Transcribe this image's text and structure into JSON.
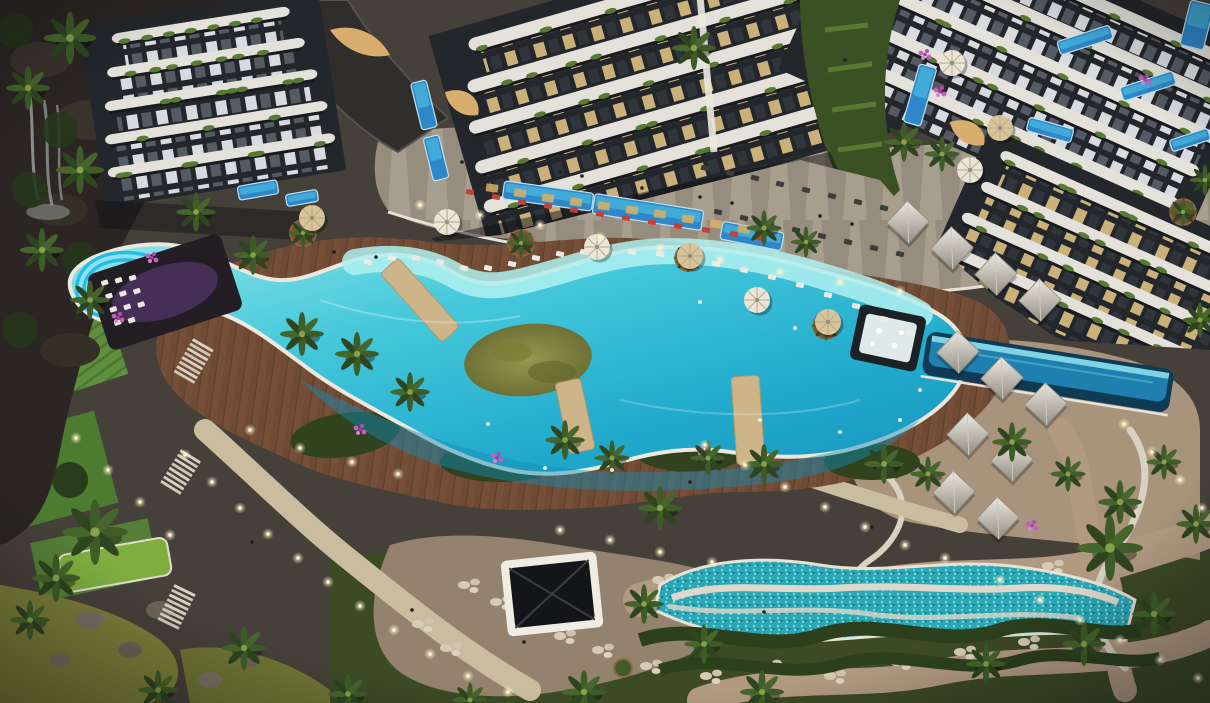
{
  "scene": {
    "description": "Night-time aerial 3D render of a luxury residential resort: curved white apartment towers at top, large S-shaped turquoise lagoon pool with olive green island and blue waterslide, brown timber sun deck with palms and umbrellas, left cliff waterfall and terraced lawns, bottom mosaic pool, stone plaza with dark gazebo, pyramid-roof cabanas and lit garden paths at right",
    "palette": {
      "ground": "#46403a",
      "cliff": "#2b2623",
      "rock": "#3a332c",
      "deck": "#6f4a34",
      "promenade": "#978d7e",
      "wall": "#e6e2d6",
      "poolRim": "#ece8dc",
      "shelf": "#aff0f0",
      "island": "#90904c",
      "islandDark": "#6e7135",
      "slide": "#25bde6",
      "slideHi": "#8fe2f4",
      "bridge": "#cdb489",
      "slab": "#e3e1da",
      "facadeDark": "#23262b",
      "tuft": "#5a7a34",
      "lawn1": "#5d8f3d",
      "lawn2": "#4d7c31",
      "lawn3": "#7fae3f",
      "garden": "#3c4a26",
      "gardenDark": "#26361c",
      "pond": "#7c7f39",
      "pond2": "#6f7434",
      "plaza": "#93836e",
      "path": "#cabc9f",
      "pathPink": "#b29a82",
      "sand": "#a8937c",
      "mosaic": "#2aa7b5",
      "hedge": "#2c401e",
      "umbrella": "#eae5d7",
      "umbrellaTan": "#d9c49a",
      "palm": "#3f5c28",
      "palmDark": "#2e4520",
      "planter": "#7a5136",
      "flower": "#c75fc0",
      "barGlow": "#8a4fb4",
      "barDark": "#221e24",
      "red": "#c24038",
      "loungerWhite": "#eceae2",
      "loungerDark": "#3c3c38",
      "infinityDeep": "#0f3b55",
      "infinityMid": "#1f7fae",
      "gold": "#d8ad6e"
    },
    "buildings": [
      {
        "name": "tower-left",
        "tx": 200,
        "ty": 20,
        "rot": -9,
        "pitch": 33,
        "slabH": 10,
        "winH": 22,
        "pat": "winA",
        "widths": [
          180,
          200,
          215,
          225,
          230
        ]
      },
      {
        "name": "tower-center",
        "tx": 640,
        "ty": -10,
        "rot": -16,
        "pitch": 40,
        "slabH": 13,
        "winH": 27,
        "pat": "winB",
        "widths": [
          360,
          385,
          405,
          415,
          420
        ]
      },
      {
        "name": "tower-right",
        "tx": 1060,
        "ty": -20,
        "rot": 24,
        "pitch": 38,
        "slabH": 12,
        "winH": 25,
        "pat": "winA",
        "widths": [
          430,
          430,
          420,
          410,
          400
        ]
      },
      {
        "name": "wing-right",
        "tx": 1140,
        "ty": 210,
        "rot": 24,
        "pitch": 36,
        "slabH": 11,
        "winH": 24,
        "pat": "winB",
        "widths": [
          300,
          310,
          320,
          330
        ]
      }
    ],
    "privatePools": [
      [
        258,
        190,
        40,
        14,
        -10
      ],
      [
        302,
        198,
        32,
        12,
        -10
      ],
      [
        424,
        105,
        16,
        48,
        -14
      ],
      [
        436,
        158,
        16,
        44,
        -14
      ],
      [
        548,
        196,
        90,
        18,
        8
      ],
      [
        648,
        212,
        110,
        20,
        9
      ],
      [
        752,
        236,
        62,
        18,
        11
      ],
      [
        920,
        95,
        18,
        60,
        16
      ],
      [
        1085,
        40,
        55,
        14,
        -18
      ],
      [
        1148,
        86,
        55,
        14,
        -18
      ],
      [
        1190,
        140,
        40,
        12,
        -18
      ],
      [
        1197,
        25,
        24,
        46,
        14
      ],
      [
        1050,
        130,
        46,
        14,
        16
      ]
    ],
    "cabanas": [
      [
        908,
        222
      ],
      [
        952,
        248
      ],
      [
        996,
        274
      ],
      [
        1040,
        300
      ],
      [
        958,
        352
      ],
      [
        1002,
        378
      ],
      [
        1046,
        404
      ],
      [
        968,
        434
      ],
      [
        1012,
        460
      ],
      [
        954,
        492
      ],
      [
        998,
        518
      ]
    ],
    "planters": [
      [
        303,
        233
      ],
      [
        521,
        243
      ],
      [
        688,
        258
      ],
      [
        826,
        326
      ],
      [
        1183,
        212
      ]
    ],
    "umbrellasWhite": [
      [
        447,
        222
      ],
      [
        597,
        247
      ],
      [
        757,
        300
      ],
      [
        952,
        63
      ],
      [
        970,
        170
      ]
    ],
    "umbrellasTan": [
      [
        312,
        218
      ],
      [
        690,
        256
      ],
      [
        828,
        322
      ],
      [
        1000,
        128
      ]
    ],
    "palms": [
      [
        70,
        38,
        1.2
      ],
      [
        28,
        88,
        1
      ],
      [
        80,
        170,
        1.1
      ],
      [
        42,
        250,
        1
      ],
      [
        90,
        300,
        0.9
      ],
      [
        95,
        532,
        1.5
      ],
      [
        56,
        578,
        1.1
      ],
      [
        30,
        620,
        0.9
      ],
      [
        196,
        212,
        0.9
      ],
      [
        253,
        255,
        0.9
      ],
      [
        302,
        334,
        1
      ],
      [
        357,
        354,
        1
      ],
      [
        410,
        392,
        0.9
      ],
      [
        565,
        440,
        0.9
      ],
      [
        612,
        458,
        0.8
      ],
      [
        660,
        508,
        1
      ],
      [
        708,
        458,
        0.8
      ],
      [
        764,
        464,
        0.9
      ],
      [
        884,
        464,
        0.9
      ],
      [
        928,
        474,
        0.8
      ],
      [
        1012,
        442,
        0.9
      ],
      [
        1068,
        474,
        0.8
      ],
      [
        1120,
        502,
        1
      ],
      [
        1164,
        462,
        0.8
      ],
      [
        1110,
        548,
        1.5
      ],
      [
        1196,
        524,
        0.9
      ],
      [
        1154,
        614,
        1
      ],
      [
        1084,
        644,
        1
      ],
      [
        986,
        664,
        0.9
      ],
      [
        762,
        692,
        1
      ],
      [
        704,
        644,
        0.9
      ],
      [
        644,
        604,
        0.9
      ],
      [
        584,
        692,
        1
      ],
      [
        694,
        48,
        1
      ],
      [
        764,
        228,
        0.8
      ],
      [
        806,
        242,
        0.7
      ],
      [
        904,
        142,
        0.9
      ],
      [
        942,
        154,
        0.8
      ],
      [
        244,
        648,
        1
      ],
      [
        158,
        690,
        0.9
      ],
      [
        1200,
        320,
        0.8
      ],
      [
        1205,
        180,
        0.7
      ],
      [
        348,
        694,
        0.9
      ],
      [
        470,
        700,
        0.8
      ]
    ],
    "lights": [
      [
        185,
        455
      ],
      [
        212,
        482
      ],
      [
        240,
        508
      ],
      [
        268,
        534
      ],
      [
        298,
        558
      ],
      [
        328,
        582
      ],
      [
        360,
        606
      ],
      [
        394,
        630
      ],
      [
        430,
        654
      ],
      [
        468,
        676
      ],
      [
        508,
        692
      ],
      [
        705,
        445
      ],
      [
        745,
        465
      ],
      [
        785,
        487
      ],
      [
        825,
        507
      ],
      [
        865,
        527
      ],
      [
        905,
        545
      ],
      [
        945,
        558
      ],
      [
        1000,
        580
      ],
      [
        1040,
        600
      ],
      [
        1080,
        620
      ],
      [
        1120,
        640
      ],
      [
        1160,
        660
      ],
      [
        1198,
        678
      ],
      [
        1124,
        424
      ],
      [
        1152,
        452
      ],
      [
        1180,
        480
      ],
      [
        1202,
        508
      ],
      [
        420,
        205
      ],
      [
        480,
        215
      ],
      [
        540,
        225
      ],
      [
        600,
        237
      ],
      [
        660,
        248
      ],
      [
        720,
        260
      ],
      [
        780,
        272
      ],
      [
        840,
        282
      ],
      [
        900,
        291
      ],
      [
        250,
        430
      ],
      [
        300,
        448
      ],
      [
        352,
        462
      ],
      [
        398,
        474
      ],
      [
        560,
        530
      ],
      [
        610,
        540
      ],
      [
        660,
        552
      ],
      [
        712,
        562
      ],
      [
        76,
        438
      ],
      [
        108,
        470
      ],
      [
        140,
        502
      ],
      [
        170,
        535
      ]
    ],
    "loungersRed": [
      [
        470,
        192
      ],
      [
        496,
        197
      ],
      [
        522,
        202
      ],
      [
        548,
        206
      ],
      [
        574,
        210
      ],
      [
        600,
        214
      ],
      [
        626,
        218
      ],
      [
        652,
        222
      ],
      [
        678,
        226
      ],
      [
        706,
        230
      ],
      [
        734,
        234
      ],
      [
        760,
        238
      ]
    ],
    "loungersDark": [
      [
        705,
        168
      ],
      [
        730,
        173
      ],
      [
        755,
        178
      ],
      [
        780,
        184
      ],
      [
        806,
        190
      ],
      [
        832,
        196
      ],
      [
        858,
        202
      ],
      [
        884,
        208
      ],
      [
        718,
        212
      ],
      [
        744,
        218
      ],
      [
        770,
        224
      ],
      [
        796,
        230
      ],
      [
        822,
        236
      ],
      [
        848,
        242
      ],
      [
        874,
        248
      ],
      [
        900,
        254
      ]
    ],
    "loungersPool": [
      [
        368,
        262
      ],
      [
        392,
        258
      ],
      [
        416,
        258
      ],
      [
        440,
        262
      ],
      [
        464,
        268
      ],
      [
        488,
        268
      ],
      [
        512,
        264
      ],
      [
        536,
        258
      ],
      [
        560,
        254
      ],
      [
        584,
        252
      ],
      [
        608,
        252
      ],
      [
        632,
        252
      ],
      [
        660,
        254
      ],
      [
        688,
        258
      ],
      [
        716,
        264
      ],
      [
        744,
        270
      ],
      [
        772,
        277
      ],
      [
        800,
        285
      ],
      [
        828,
        295
      ],
      [
        856,
        306
      ],
      [
        884,
        319
      ],
      [
        910,
        333
      ]
    ],
    "glowWindows": [
      [
        492,
        188
      ],
      [
        520,
        193
      ],
      [
        548,
        198
      ],
      [
        576,
        202
      ],
      [
        604,
        206
      ],
      [
        632,
        210
      ],
      [
        660,
        214
      ],
      [
        688,
        219
      ],
      [
        716,
        224
      ],
      [
        744,
        229
      ]
    ],
    "flowers": [
      [
        925,
        55
      ],
      [
        940,
        92
      ],
      [
        360,
        430
      ],
      [
        497,
        458
      ],
      [
        702,
        450
      ],
      [
        884,
        464
      ],
      [
        1032,
        526
      ],
      [
        118,
        318
      ],
      [
        1145,
        80
      ],
      [
        152,
        258
      ]
    ],
    "stones": [
      [
        470,
        585
      ],
      [
        502,
        602
      ],
      [
        534,
        620
      ],
      [
        566,
        636
      ],
      [
        604,
        650
      ],
      [
        648,
        598
      ],
      [
        664,
        580
      ],
      [
        702,
        594
      ],
      [
        742,
        608
      ],
      [
        782,
        596
      ],
      [
        832,
        610
      ],
      [
        872,
        586
      ],
      [
        918,
        600
      ],
      [
        962,
        588
      ],
      [
        1008,
        576
      ],
      [
        1054,
        566
      ],
      [
        652,
        666
      ],
      [
        712,
        676
      ],
      [
        772,
        666
      ],
      [
        836,
        676
      ],
      [
        902,
        662
      ],
      [
        966,
        652
      ],
      [
        1030,
        642
      ],
      [
        452,
        648
      ],
      [
        424,
        624
      ]
    ],
    "stairs": [
      [
        193,
        362,
        30
      ],
      [
        180,
        473,
        32
      ],
      [
        176,
        608,
        26
      ]
    ],
    "people": [
      [
        560,
        172
      ],
      [
        582,
        176
      ],
      [
        612,
        182
      ],
      [
        642,
        188
      ],
      [
        700,
        197
      ],
      [
        732,
        203
      ],
      [
        462,
        162
      ],
      [
        820,
        216
      ],
      [
        852,
        224
      ],
      [
        334,
        252
      ],
      [
        376,
        257
      ],
      [
        690,
        482
      ],
      [
        872,
        527
      ],
      [
        252,
        542
      ],
      [
        412,
        610
      ],
      [
        524,
        642
      ],
      [
        764,
        612
      ],
      [
        950,
        120
      ],
      [
        845,
        60
      ]
    ],
    "swimmers": [
      [
        488,
        424
      ],
      [
        545,
        468
      ],
      [
        612,
        470
      ],
      [
        840,
        432
      ],
      [
        900,
        420
      ],
      [
        795,
        328
      ],
      [
        700,
        302
      ],
      [
        760,
        420
      ],
      [
        920,
        390
      ]
    ],
    "cliffTrees": [
      [
        15,
        30
      ],
      [
        60,
        130
      ],
      [
        30,
        190
      ],
      [
        80,
        260
      ],
      [
        20,
        330
      ],
      [
        70,
        480
      ]
    ],
    "rocks": [
      [
        90,
        620
      ],
      [
        130,
        650
      ],
      [
        60,
        660
      ],
      [
        160,
        610
      ],
      [
        210,
        680
      ],
      [
        250,
        660
      ]
    ]
  }
}
